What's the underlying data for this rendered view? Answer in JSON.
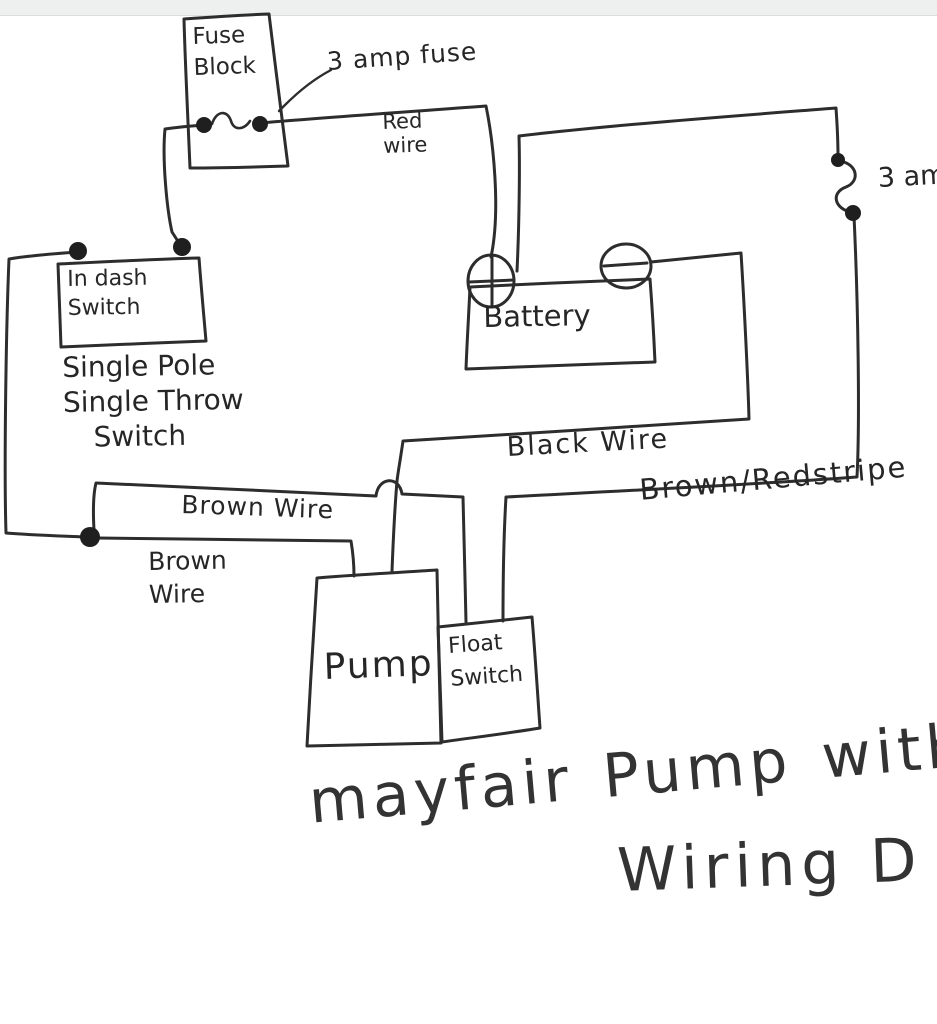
{
  "window": {
    "top_strip_color": "#eef0ef"
  },
  "ink_color": "#2d2d2d",
  "components": {
    "fuse_block": {
      "line1": "Fuse",
      "line2": "Block"
    },
    "in_dash_switch": {
      "line1": "In dash",
      "line2": "Switch"
    },
    "spst_note": {
      "line1": "Single Pole",
      "line2": "Single Throw",
      "line3": "Switch"
    },
    "battery": {
      "label": "Battery"
    },
    "pump": {
      "label": "Pump"
    },
    "float_switch": {
      "line1": "Float",
      "line2": "Switch"
    }
  },
  "wire_labels": {
    "fuse_callout": "3 amp fuse",
    "red_wire_line1": "Red",
    "red_wire_line2": "wire",
    "right_fuse": "3 am",
    "black_wire": "Black Wire",
    "brown_wire_upper": "Brown Wire",
    "brown_wire_lower_line1": "Brown",
    "brown_wire_lower_line2": "Wire",
    "brown_red_stripe": "Brown/Redstripe"
  },
  "title": {
    "line1": "mayfair Pump with",
    "line2": "Wiring D"
  }
}
